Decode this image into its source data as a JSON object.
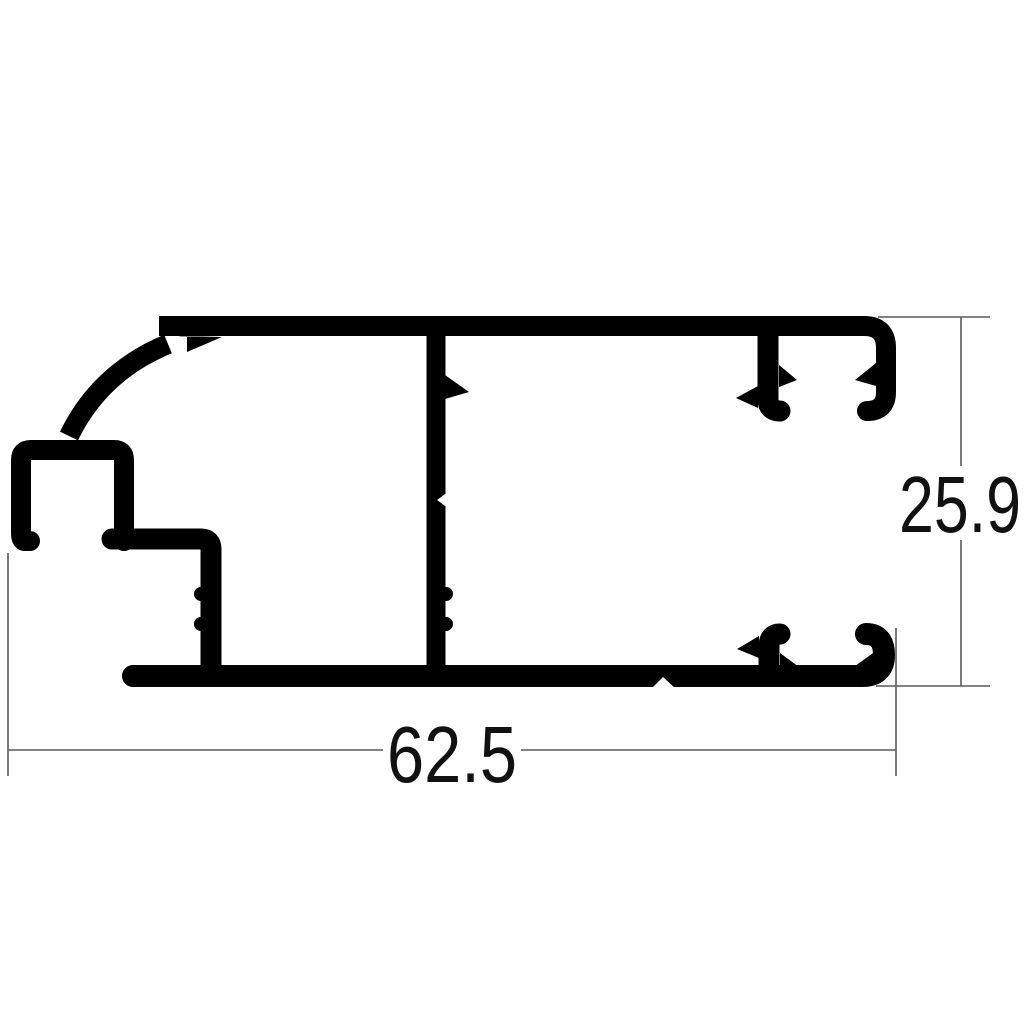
{
  "figure": {
    "type": "technical-drawing-cross-section",
    "background_color": "#ffffff",
    "profile_color": "#000000",
    "dimension_line_color": "#5a5a5a",
    "dimension_text_color": "#111111"
  },
  "dimensions": {
    "width_label": "62.5",
    "height_label": "25.9"
  }
}
